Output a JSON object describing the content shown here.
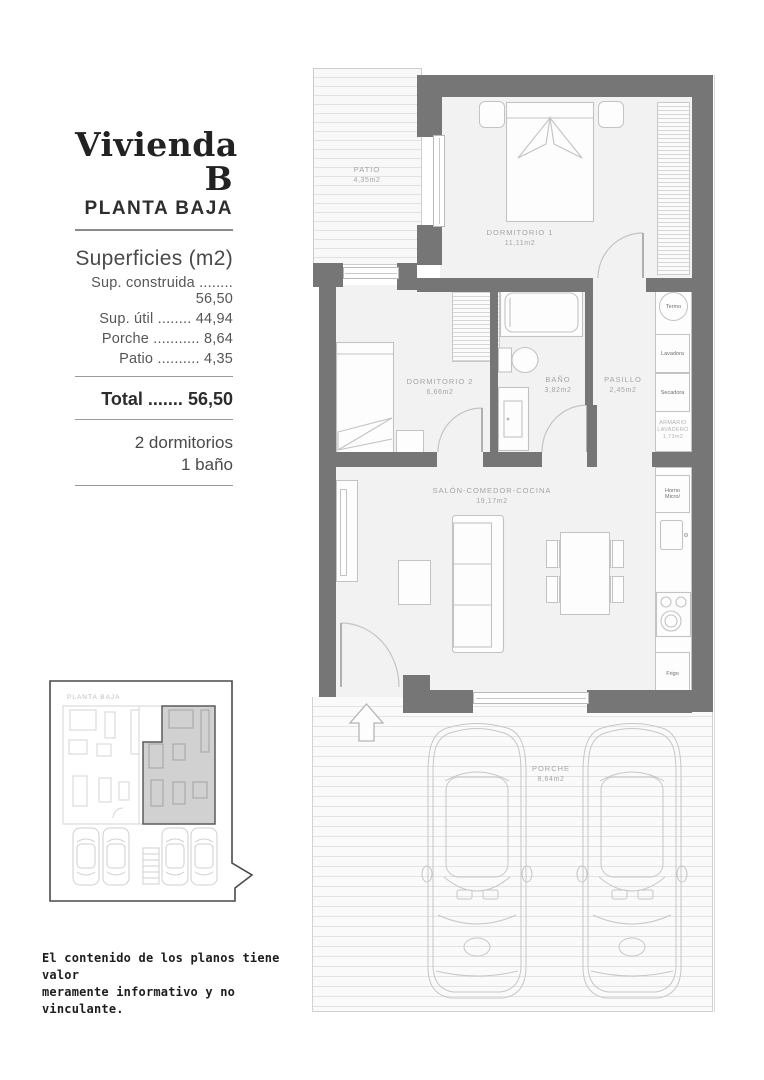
{
  "sidebar": {
    "title": "Vivienda B",
    "subtitle": "PLANTA BAJA",
    "surfaces_heading": "Superficies (m2)",
    "surface_rows": [
      {
        "label": "Sup. construida",
        "dots": "........",
        "value": "56,50"
      },
      {
        "label": "Sup. útil",
        "dots": "........",
        "value": "44,94"
      },
      {
        "label": "Porche",
        "dots": "...........",
        "value": "8,64"
      },
      {
        "label": "Patio",
        "dots": "..........",
        "value": "4,35"
      }
    ],
    "total": {
      "label": "Total",
      "dots": ".......",
      "value": "56,50"
    },
    "program": [
      "2 dormitorios",
      "1 baño"
    ]
  },
  "plan": {
    "patio": {
      "name": "PATIO",
      "area": "4,35m2"
    },
    "dormitorio1": {
      "name": "DORMITORIO 1",
      "area": "11,11m2"
    },
    "dormitorio2": {
      "name": "DORMITORIO 2",
      "area": "6,66m2"
    },
    "bano": {
      "name": "BAÑO",
      "area": "3,82m2"
    },
    "pasillo": {
      "name": "PASILLO",
      "area": "2,45m2"
    },
    "salon": {
      "name": "SALÓN-COMEDOR-COCINA",
      "area": "19,17m2"
    },
    "porche": {
      "name": "PORCHE",
      "area": "8,64m2"
    },
    "armario": {
      "line1": "ARMARIO",
      "line2": "LAVADERO",
      "area": "1,73m2"
    },
    "appliances": {
      "termo": "Termo",
      "lavadora": "Lavadora",
      "secadora": "Secadora",
      "horno": "Horno",
      "micro": "Micro/",
      "frigo": "Frigo"
    }
  },
  "keyplan": {
    "label": "PLANTA BAJA"
  },
  "disclaimer": {
    "line1": "El contenido de los planos tiene valor",
    "line2": "meramente informativo y no vinculante."
  },
  "colors": {
    "wall": "#767676",
    "floor": "#f2f2f2",
    "label": "#a5a5a5",
    "highlight": "#c9c9c9"
  }
}
